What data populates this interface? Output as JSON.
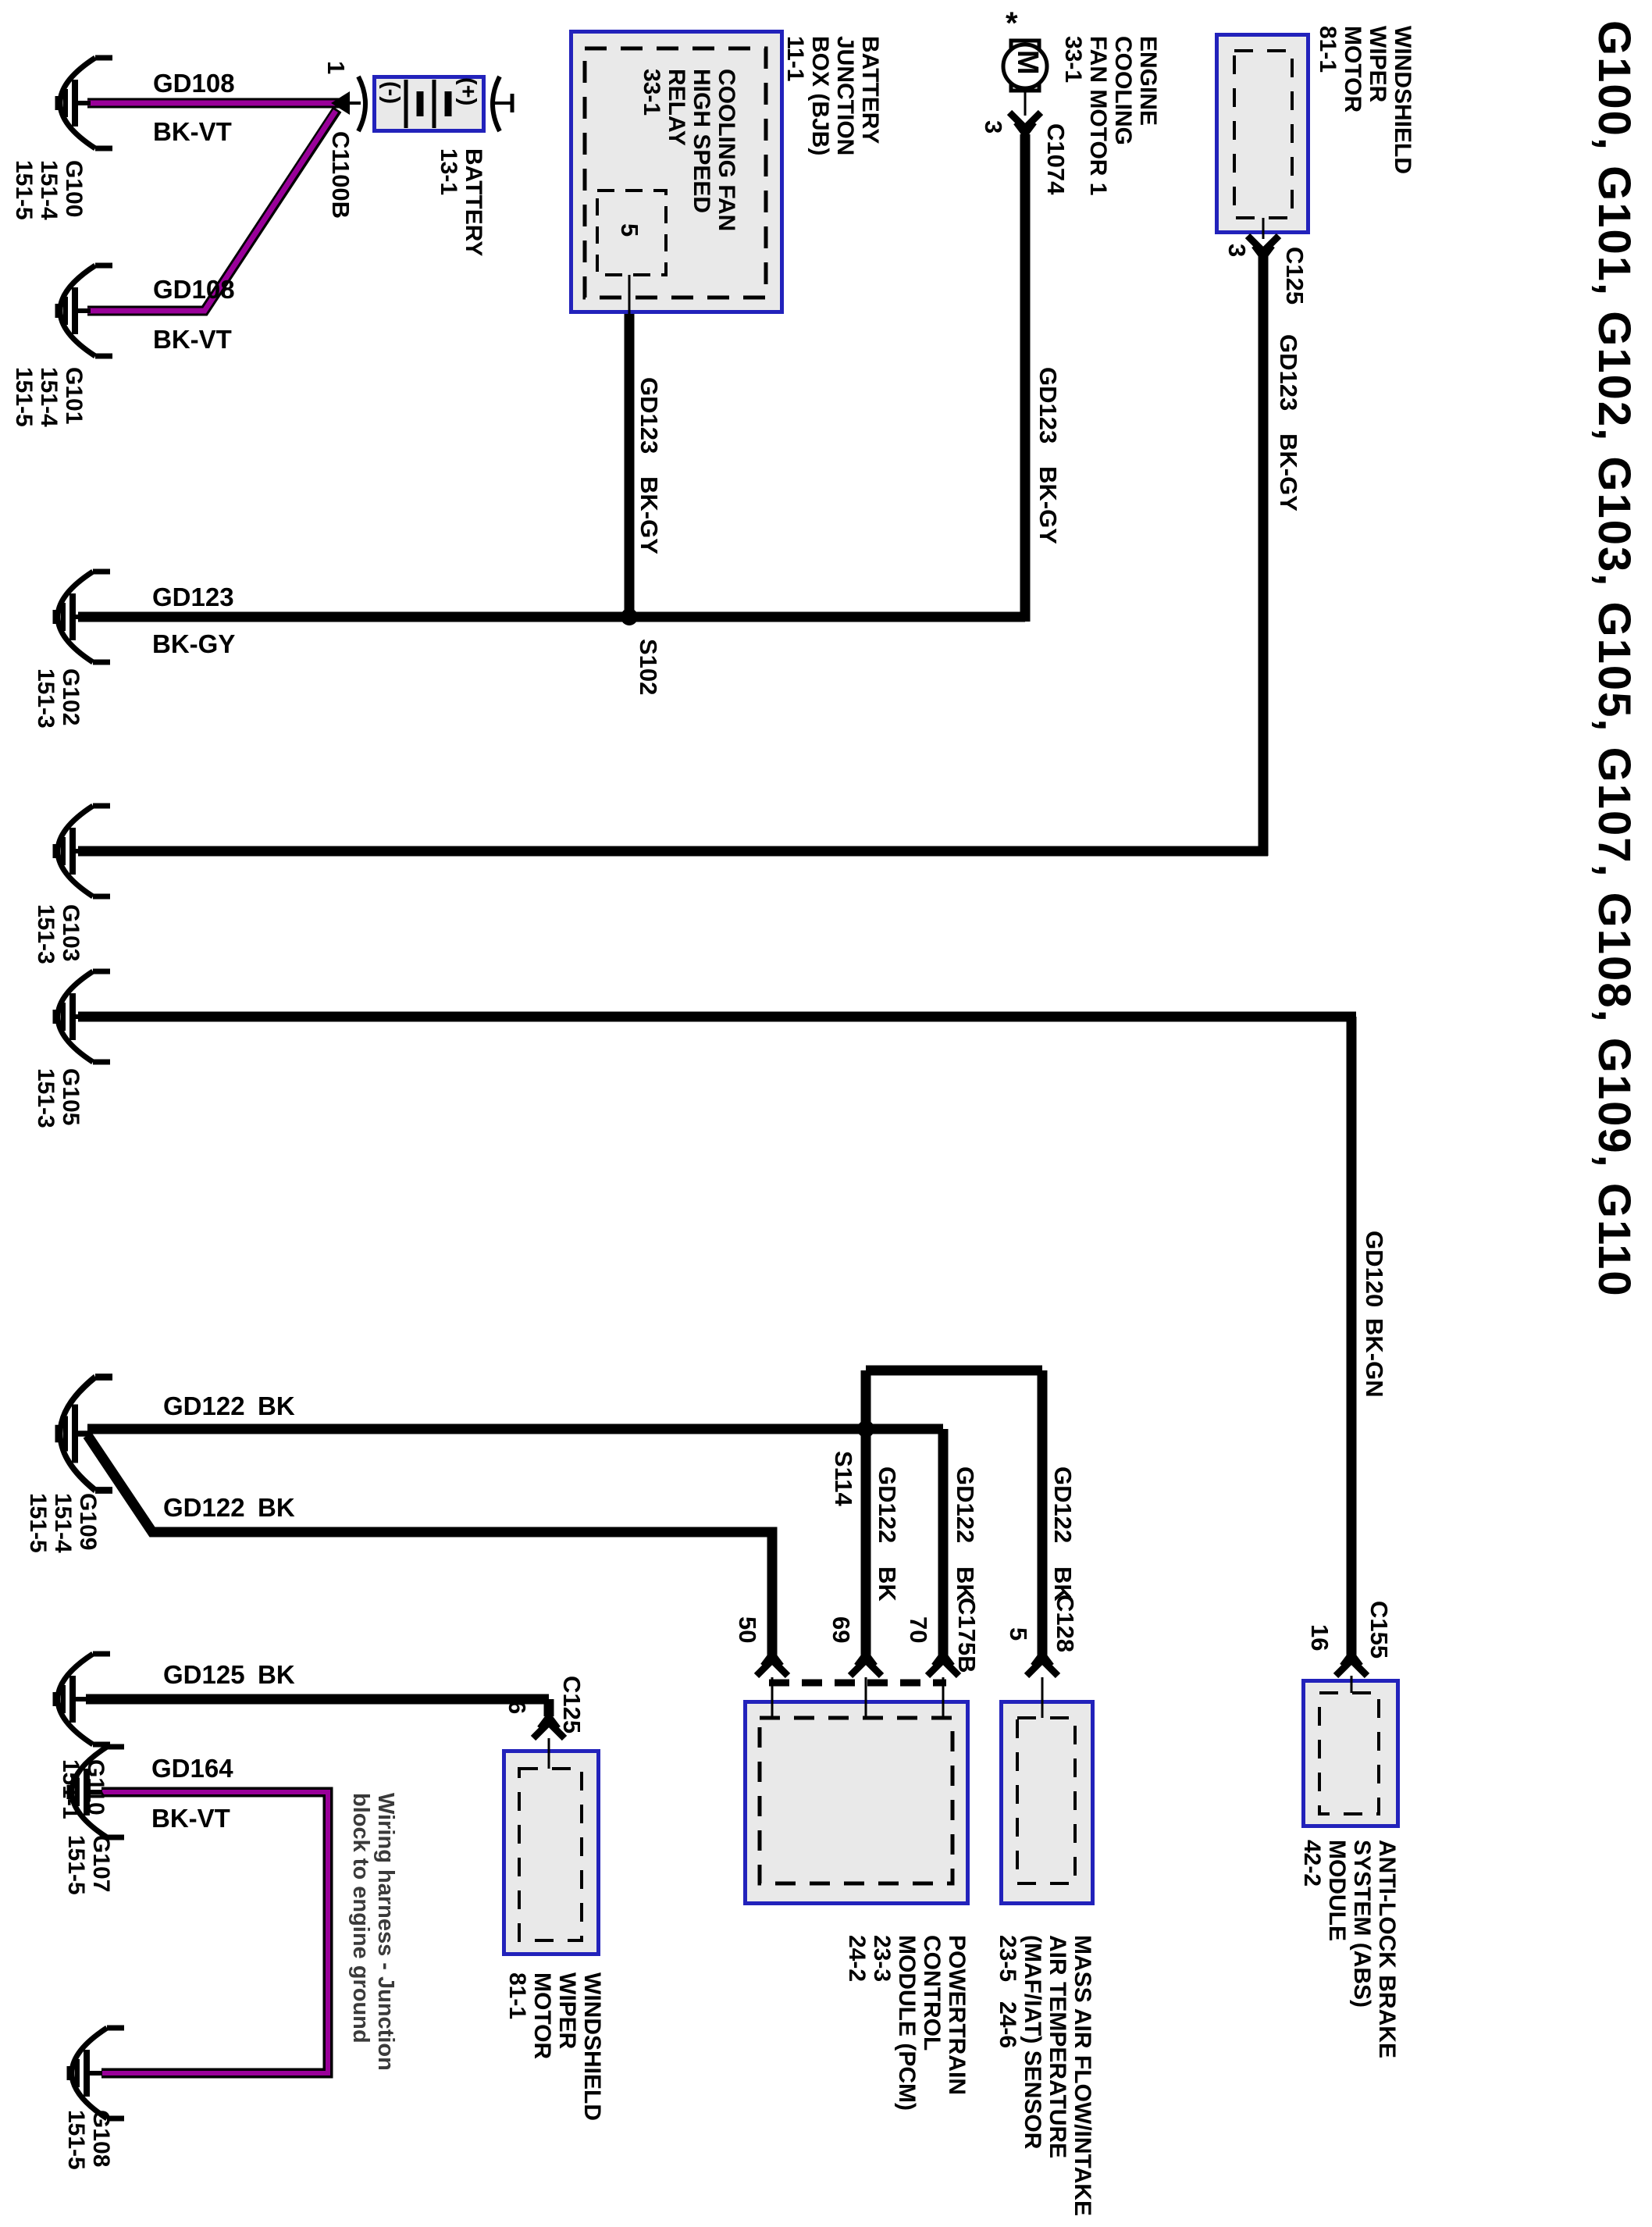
{
  "title": "G100, G101, G102, G103, G105, G107, G108, G109, G110",
  "note": {
    "line1": "Wiring harness - Junction",
    "line2": "block to engine ground"
  },
  "splices": {
    "s102": "S102",
    "s114": "S114"
  },
  "battery": {
    "name": "BATTERY",
    "ref": "13-1",
    "neg": "(-)",
    "pos": "(+)",
    "pin": "1",
    "connector": "C1100B"
  },
  "bjb": {
    "l1": "BATTERY",
    "l2": "JUNCTION",
    "l3": "BOX (BJB)",
    "l4": "11-1"
  },
  "relay": {
    "l1": "COOLING FAN",
    "l2": "HIGH SPEED",
    "l3": "RELAY",
    "l4": "33-1",
    "pin": "5"
  },
  "fan_motor": {
    "l1": "ENGINE",
    "l2": "COOLING",
    "l3": "FAN MOTOR 1",
    "l4": "33-1",
    "m": "M",
    "star": "*",
    "pin": "3",
    "connector": "C1074"
  },
  "wiper_top": {
    "l1": "WINDSHIELD",
    "l2": "WIPER",
    "l3": "MOTOR",
    "l4": "81-1",
    "pin": "3",
    "connector": "C125"
  },
  "wiper_bottom": {
    "l1": "WINDSHIELD",
    "l2": "WIPER",
    "l3": "MOTOR",
    "l4": "81-1",
    "pin": "6",
    "connector": "C125"
  },
  "pcm": {
    "l1": "POWERTRAIN",
    "l2": "CONTROL",
    "l3": "MODULE (PCM)",
    "l4": "23-3",
    "l5": "24-2",
    "pin50": "50",
    "pin69": "69",
    "pin70": "70",
    "connector": "C175B"
  },
  "maf": {
    "l1": "MASS AIR FLOW/INTAKE",
    "l2": "AIR TEMPERATURE",
    "l3": "(MAF/IAT) SENSOR",
    "l4": "23-5   24-6",
    "pin": "5",
    "connector": "C128"
  },
  "abs": {
    "l1": "ANTI-LOCK BRAKE",
    "l2": "SYSTEM (ABS)",
    "l3": "MODULE",
    "l4": "42-2",
    "pin": "16",
    "connector": "C155"
  },
  "grounds": {
    "g100": {
      "name": "G100",
      "r1": "151-4",
      "r2": "151-5"
    },
    "g101": {
      "name": "G101",
      "r1": "151-4",
      "r2": "151-5"
    },
    "g102": {
      "name": "G102",
      "r1": "151-3"
    },
    "g103": {
      "name": "G103",
      "r1": "151-3"
    },
    "g105": {
      "name": "G105",
      "r1": "151-3"
    },
    "g107": {
      "name": "G107",
      "r1": "151-5"
    },
    "g108": {
      "name": "G108",
      "r1": "151-5"
    },
    "g109": {
      "name": "G109",
      "r1": "151-4",
      "r2": "151-5"
    },
    "g110": {
      "name": "G110",
      "r1": "151-1"
    }
  },
  "wires": {
    "gd108": "GD108",
    "bkvt": "BK-VT",
    "gd123": "GD123",
    "bkgy": "BK-GY",
    "gd122": "GD122",
    "bk": "BK",
    "gd125": "GD125",
    "gd164": "GD164",
    "gd120": "GD120",
    "bkgn": "BK-GN"
  },
  "colors": {
    "wire_purple": "#990099",
    "box_border": "#2222bb",
    "box_fill": "#e9e9e9"
  }
}
